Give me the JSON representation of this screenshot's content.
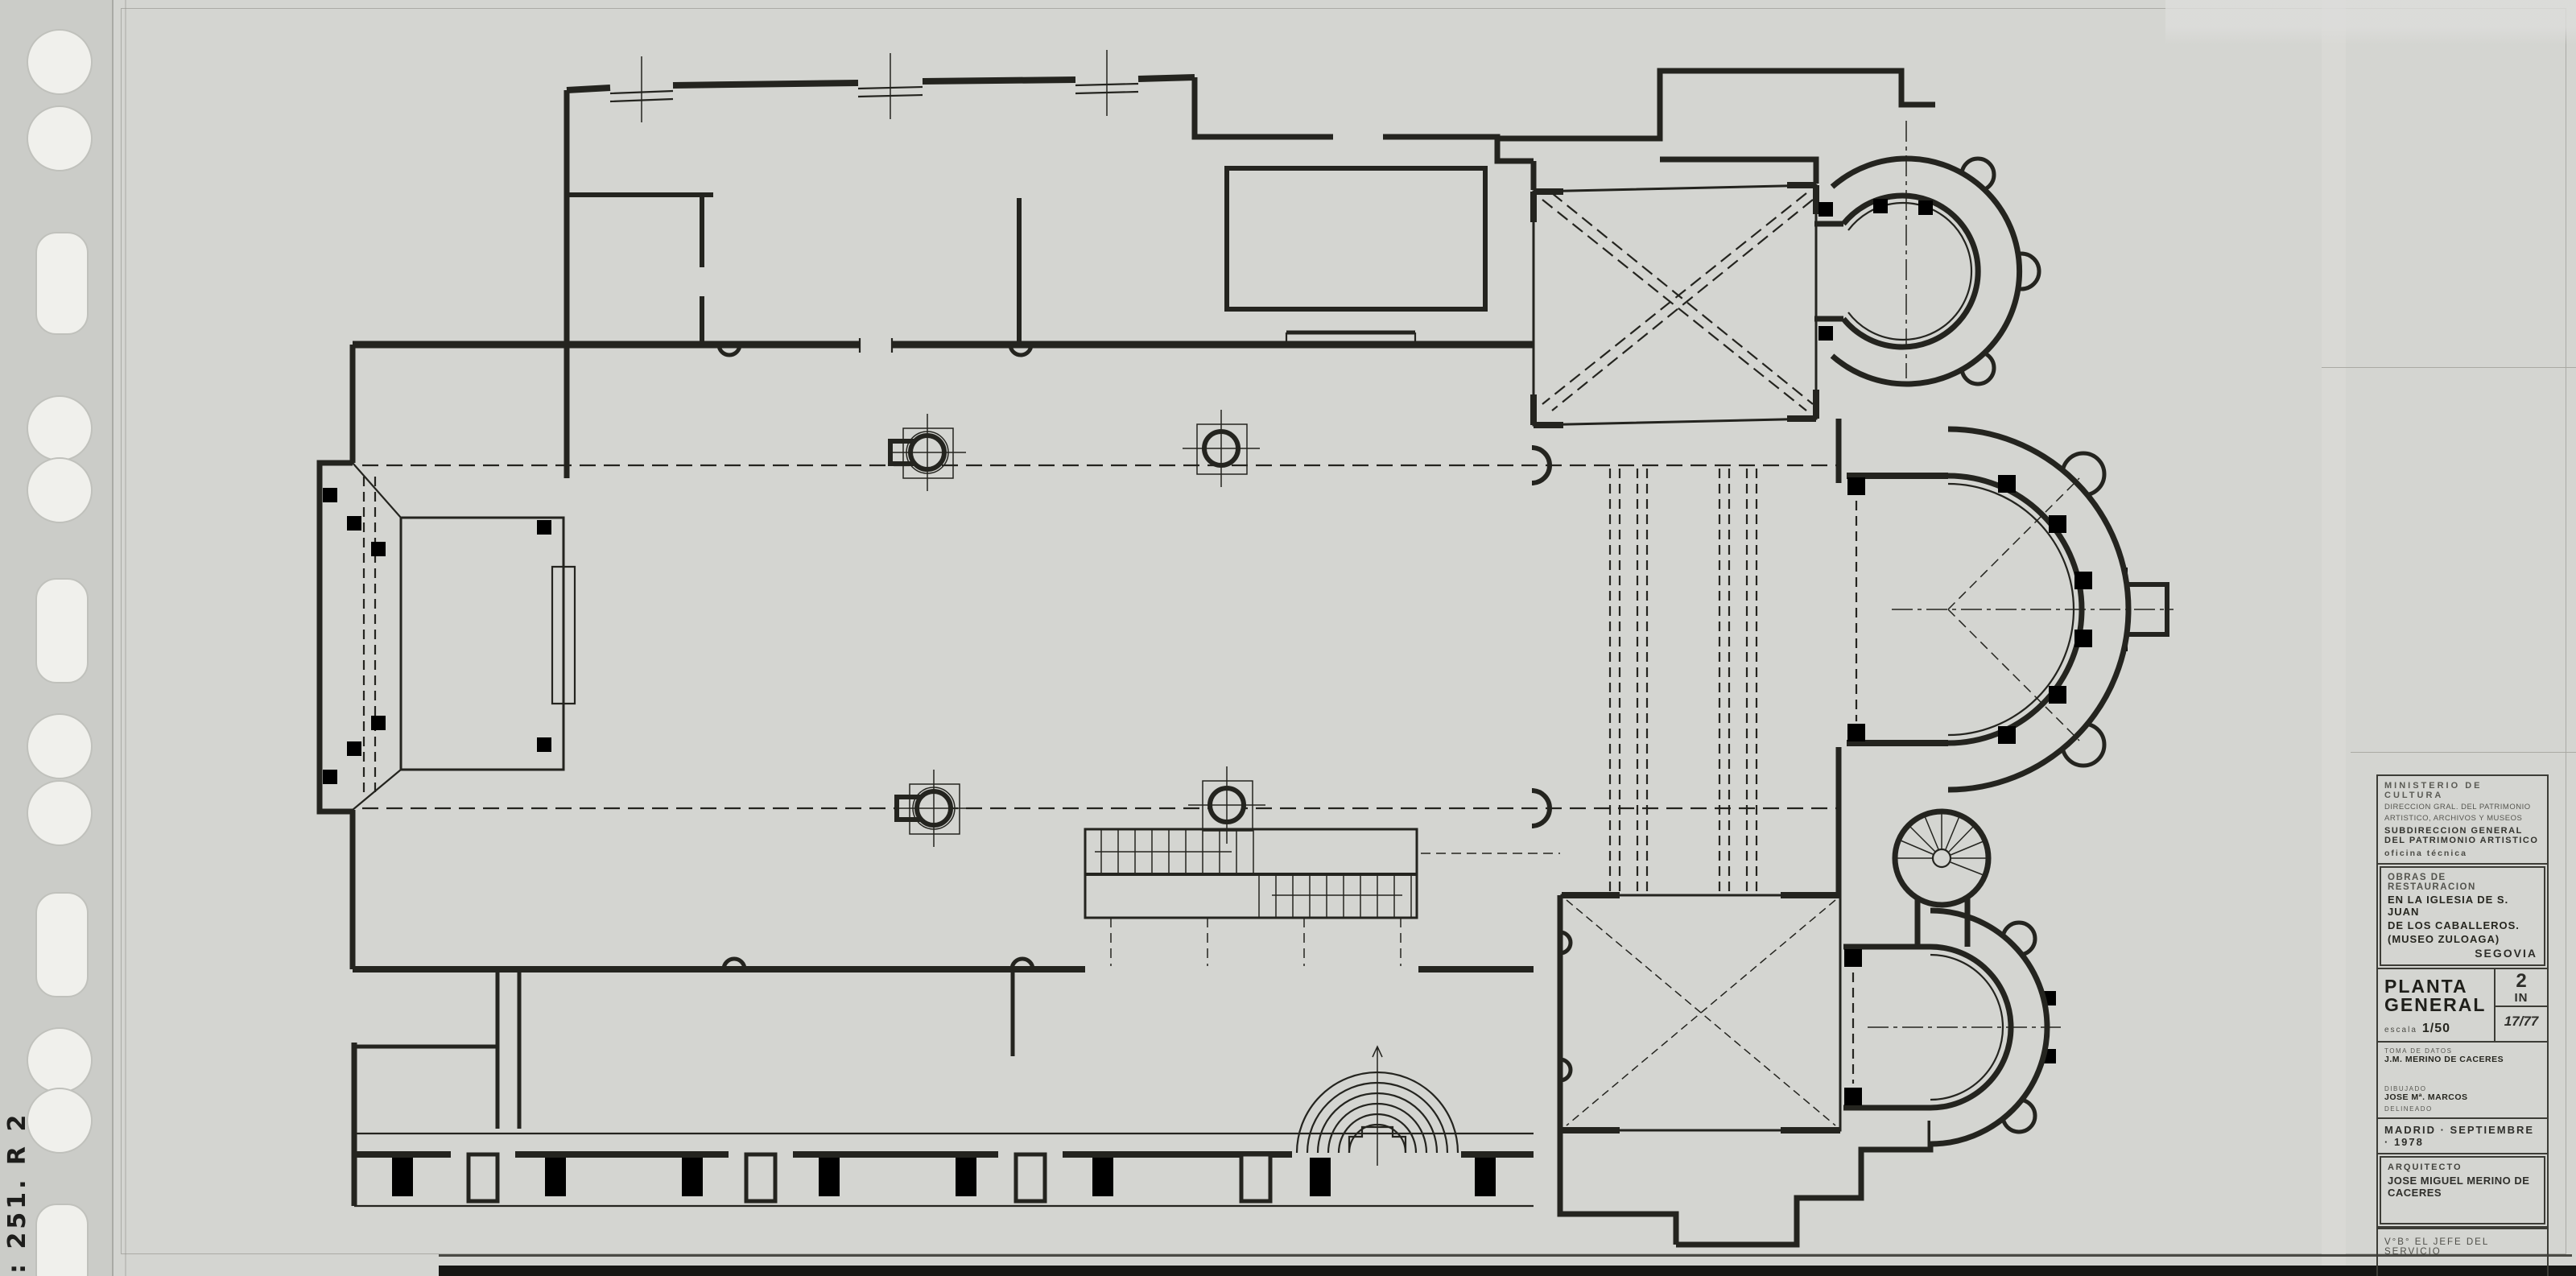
{
  "sheet": {
    "handwritten_note": ": 251. R 2",
    "paper_color": "#d4d5d1",
    "ink_color": "#24241f"
  },
  "title_block": {
    "ministry_line1": "MINISTERIO DE CULTURA",
    "ministry_line2": "DIRECCION GRAL. DEL PATRIMONIO",
    "ministry_line3": "ARTISTICO, ARCHIVOS Y MUSEOS",
    "subdirection_line1": "SUBDIRECCION GENERAL",
    "subdirection_line2": "DEL PATRIMONIO ARTISTICO",
    "office": "oficina técnica",
    "works_title": "OBRAS DE RESTAURACION",
    "works_line1": "EN LA IGLESIA DE S. JUAN",
    "works_line2": "DE LOS CABALLEROS.",
    "works_line3": "(MUSEO ZULOAGA)",
    "works_city": "SEGOVIA",
    "drawing_title_line1": "PLANTA",
    "drawing_title_line2": "GENERAL",
    "scale_label": "escala",
    "scale_value": "1/50",
    "sheet_number_top": "2",
    "sheet_number_bottom": "IN",
    "sheet_index": "17/77",
    "data_by_label": "TOMA DE DATOS",
    "data_by_name": "J.M. MERINO DE CACERES",
    "drawn_by_label": "DIBUJADO",
    "drawn_by_name": "JOSE Mª. MARCOS",
    "delineated_label": "DELINEADO",
    "date_line": "MADRID · SEPTIEMBRE · 1978",
    "architect_label": "ARQUITECTO",
    "architect_name": "JOSE MIGUEL MERINO DE CACERES",
    "approval_line": "V°B° EL JEFE DEL SERVICIO"
  }
}
